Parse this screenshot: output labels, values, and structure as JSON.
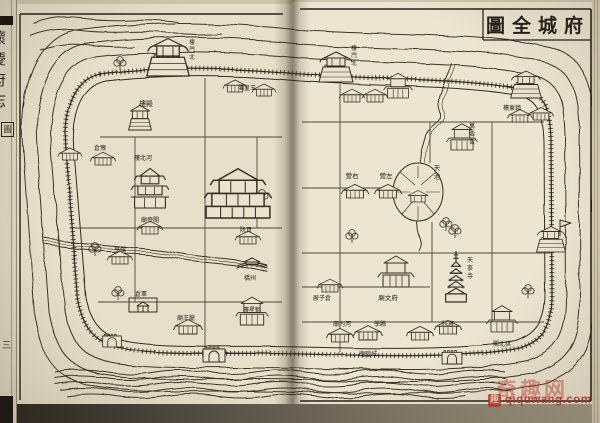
{
  "title": {
    "text_rtl": "圖全城府"
  },
  "spine": {
    "book_title": "懷慶府志",
    "box_char": "圖",
    "page_mark": "三"
  },
  "watermark": {
    "site": "qiquwang.com",
    "logo_char": "趣",
    "chars": "奇趣网",
    "color": "#c43428"
  },
  "map": {
    "ink": "#332c24",
    "paper": "#ebe3cd",
    "roads": [
      [
        205,
        78,
        205,
        350
      ],
      [
        100,
        137,
        282,
        137
      ],
      [
        70,
        228,
        282,
        228
      ],
      [
        135,
        137,
        135,
        302
      ],
      [
        98,
        302,
        282,
        302
      ],
      [
        257,
        137,
        257,
        228
      ],
      [
        340,
        84,
        340,
        352
      ],
      [
        302,
        122,
        544,
        122
      ],
      [
        302,
        188,
        430,
        188
      ],
      [
        302,
        253,
        550,
        253
      ],
      [
        302,
        322,
        544,
        322
      ],
      [
        430,
        122,
        430,
        163
      ],
      [
        432,
        222,
        432,
        322
      ],
      [
        492,
        122,
        492,
        322
      ],
      [
        302,
        287,
        430,
        287
      ]
    ],
    "buildings": [
      {
        "s": "gate",
        "x": 168,
        "y": 76,
        "k": 1.25,
        "name": "north-gate-tower-left"
      },
      {
        "s": "gate",
        "x": 336,
        "y": 82,
        "k": 1.0,
        "name": "north-gate-tower-right"
      },
      {
        "s": "gate",
        "x": 526,
        "y": 98,
        "k": 0.9,
        "name": "northeast-corner-tower"
      },
      {
        "s": "gate",
        "x": 551,
        "y": 252,
        "k": 0.85,
        "name": "east-gate-tower"
      },
      {
        "s": "flag",
        "x": 560,
        "y": 236,
        "k": 1,
        "name": "east-gate-flag"
      },
      {
        "s": "arch",
        "x": 214,
        "y": 362,
        "k": 1,
        "name": "south-gate-left"
      },
      {
        "s": "arch",
        "x": 112,
        "y": 347,
        "k": 0.85,
        "name": "southwest-gate"
      },
      {
        "s": "arch",
        "x": 452,
        "y": 364,
        "k": 0.9,
        "name": "south-gate-right"
      },
      {
        "s": "house",
        "x": 70,
        "y": 160,
        "k": 0.75,
        "name": "west-wall-building"
      },
      {
        "s": "tower",
        "x": 140,
        "y": 130,
        "k": 0.95,
        "name": "hall-tower"
      },
      {
        "s": "tower3",
        "x": 150,
        "y": 208,
        "k": 1.1,
        "name": "hebei-tower"
      },
      {
        "s": "bigtemple",
        "x": 238,
        "y": 218,
        "k": 1.45,
        "name": "central-complex"
      },
      {
        "s": "house",
        "x": 103,
        "y": 165,
        "k": 0.8,
        "name": "granary"
      },
      {
        "s": "house",
        "x": 150,
        "y": 234,
        "k": 0.8,
        "name": "guandi-temple"
      },
      {
        "s": "house",
        "x": 188,
        "y": 334,
        "k": 0.9,
        "name": "longwang-temple"
      },
      {
        "s": "compound",
        "x": 143,
        "y": 312,
        "k": 1,
        "name": "walled-compound"
      },
      {
        "s": "house",
        "x": 248,
        "y": 244,
        "k": 0.8,
        "name": "examination-hall"
      },
      {
        "s": "house2",
        "x": 252,
        "y": 325,
        "k": 0.9,
        "name": "kuixing-tower"
      },
      {
        "s": "bridge",
        "x": 252,
        "y": 266,
        "k": 1,
        "name": "zhou-bridge"
      },
      {
        "s": "house",
        "x": 120,
        "y": 264,
        "k": 0.8,
        "name": "school"
      },
      {
        "s": "house",
        "x": 235,
        "y": 92,
        "k": 0.75,
        "name": "small-temple-a"
      },
      {
        "s": "house",
        "x": 264,
        "y": 96,
        "k": 0.75,
        "name": "small-temple-b"
      },
      {
        "s": "house",
        "x": 352,
        "y": 102,
        "k": 0.8,
        "name": "row-house-a"
      },
      {
        "s": "house",
        "x": 375,
        "y": 102,
        "k": 0.8,
        "name": "row-house-b"
      },
      {
        "s": "house2",
        "x": 398,
        "y": 98,
        "k": 0.8,
        "name": "row-house-c"
      },
      {
        "s": "house",
        "x": 355,
        "y": 198,
        "k": 0.85,
        "name": "right-camp"
      },
      {
        "s": "house",
        "x": 388,
        "y": 198,
        "k": 0.85,
        "name": "left-camp"
      },
      {
        "s": "house2",
        "x": 462,
        "y": 150,
        "k": 0.85,
        "name": "wanshou-palace"
      },
      {
        "s": "pagoda",
        "x": 456,
        "y": 302,
        "k": 1.15,
        "name": "tianning-pagoda"
      },
      {
        "s": "house2",
        "x": 396,
        "y": 287,
        "k": 1.0,
        "name": "prefecture-confucian-temple"
      },
      {
        "s": "house",
        "x": 330,
        "y": 292,
        "k": 0.8,
        "name": "granary-right"
      },
      {
        "s": "house",
        "x": 340,
        "y": 342,
        "k": 0.85,
        "name": "south-row-a"
      },
      {
        "s": "house",
        "x": 368,
        "y": 340,
        "k": 0.9,
        "name": "chenghuang-temple"
      },
      {
        "s": "house",
        "x": 420,
        "y": 340,
        "k": 0.85,
        "name": "south-row-b"
      },
      {
        "s": "house",
        "x": 448,
        "y": 334,
        "k": 0.85,
        "name": "censorate"
      },
      {
        "s": "house2",
        "x": 502,
        "y": 332,
        "k": 0.85,
        "name": "gongbei-pavilion"
      },
      {
        "s": "house",
        "x": 520,
        "y": 122,
        "k": 0.78,
        "name": "northeast-house-a"
      },
      {
        "s": "house",
        "x": 541,
        "y": 120,
        "k": 0.78,
        "name": "northeast-house-b"
      }
    ],
    "labels": [
      {
        "t": "樓殿",
        "x": 146,
        "y": 106,
        "o": "h",
        "fs": 7
      },
      {
        "t": "樓北河",
        "x": 143,
        "y": 160,
        "o": "h",
        "fs": 6
      },
      {
        "t": "倉豫",
        "x": 100,
        "y": 150,
        "o": "h",
        "fs": 6
      },
      {
        "t": "閣皇玉",
        "x": 247,
        "y": 90,
        "o": "h",
        "fs": 6
      },
      {
        "t": "廟帝關",
        "x": 150,
        "y": 222,
        "o": "h",
        "fs": 6
      },
      {
        "t": "院貢",
        "x": 246,
        "y": 232,
        "o": "h",
        "fs": 6
      },
      {
        "t": "橋州",
        "x": 250,
        "y": 280,
        "o": "h",
        "fs": 6
      },
      {
        "t": "學儒",
        "x": 120,
        "y": 252,
        "o": "h",
        "fs": 6
      },
      {
        "t": "倉軍",
        "x": 141,
        "y": 296,
        "o": "h",
        "fs": 6
      },
      {
        "t": "廟王龍",
        "x": 186,
        "y": 320,
        "o": "h",
        "fs": 6
      },
      {
        "t": "樓星魁",
        "x": 252,
        "y": 312,
        "o": "h",
        "fs": 6
      },
      {
        "t": "營右",
        "x": 352,
        "y": 178,
        "o": "h",
        "fs": 6.5
      },
      {
        "t": "營左",
        "x": 386,
        "y": 178,
        "o": "h",
        "fs": 6.5
      },
      {
        "t": "天池",
        "x": 437,
        "y": 170,
        "o": "v",
        "fs": 6.5
      },
      {
        "t": "廟隍城",
        "x": 368,
        "y": 356,
        "o": "h",
        "fs": 6
      },
      {
        "t": "廟文府",
        "x": 388,
        "y": 300,
        "o": "h",
        "fs": 6.5
      },
      {
        "t": "學縣",
        "x": 380,
        "y": 326,
        "o": "h",
        "fs": 6
      },
      {
        "t": "廟內河",
        "x": 342,
        "y": 326,
        "o": "h",
        "fs": 6
      },
      {
        "t": "厫子倉",
        "x": 322,
        "y": 300,
        "o": "h",
        "fs": 6
      },
      {
        "t": "萬壽宮",
        "x": 472,
        "y": 128,
        "o": "v",
        "fs": 6
      },
      {
        "t": "天寧寺",
        "x": 470,
        "y": 262,
        "o": "v",
        "fs": 6
      },
      {
        "t": "樓東鎮",
        "x": 512,
        "y": 110,
        "o": "h",
        "fs": 6
      },
      {
        "t": "院察",
        "x": 448,
        "y": 326,
        "o": "h",
        "fs": 6
      },
      {
        "t": "閣北拱",
        "x": 502,
        "y": 346,
        "o": "h",
        "fs": 6
      },
      {
        "t": "樓門北",
        "x": 192,
        "y": 44,
        "o": "v",
        "fs": 5.5
      },
      {
        "t": "樓門北",
        "x": 354,
        "y": 50,
        "o": "v",
        "fs": 5.5
      }
    ],
    "trees": [
      [
        118,
        300
      ],
      [
        95,
        256
      ],
      [
        262,
        203
      ],
      [
        352,
        243
      ],
      [
        446,
        231
      ],
      [
        455,
        238
      ],
      [
        528,
        298
      ],
      [
        120,
        70
      ]
    ]
  }
}
